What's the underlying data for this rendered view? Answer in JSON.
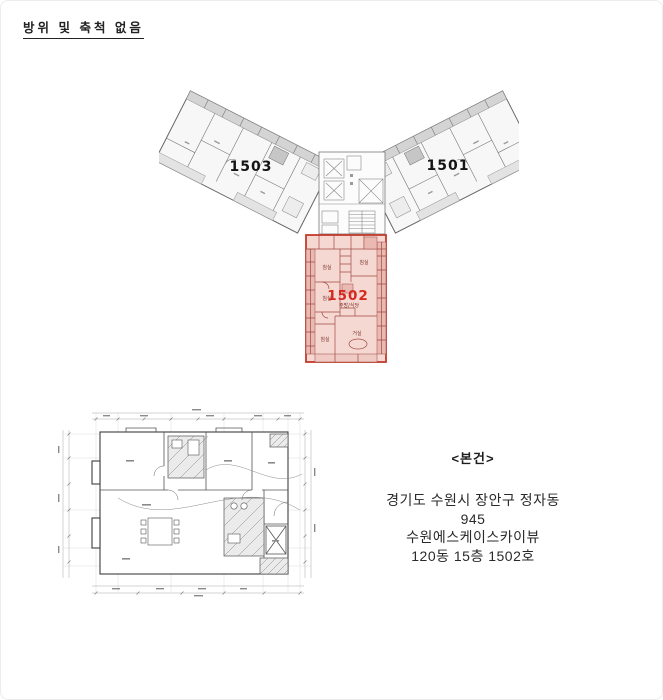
{
  "page": {
    "scale_note": "방위 및 축척 없음"
  },
  "floor_plan": {
    "unit_left_label": "1503",
    "unit_right_label": "1501",
    "subject_unit_label": "1502",
    "subject_rooms": {
      "bedroom1": "침실",
      "bedroom2": "침실",
      "bedroom3": "침실",
      "bedroom4": "침실",
      "kitchen": "주방/식당",
      "living": "거실"
    },
    "colors": {
      "highlight_border": "#c23b2b",
      "highlight_fill": "#f6d8d2",
      "highlight_label": "#d6281e",
      "plan_line": "#666666"
    }
  },
  "subject_info": {
    "heading": "<본건>",
    "lines": [
      "경기도 수원시 장안구 정자동",
      "945",
      "수원에스케이스카이뷰",
      "120동 15층 1502호"
    ]
  }
}
